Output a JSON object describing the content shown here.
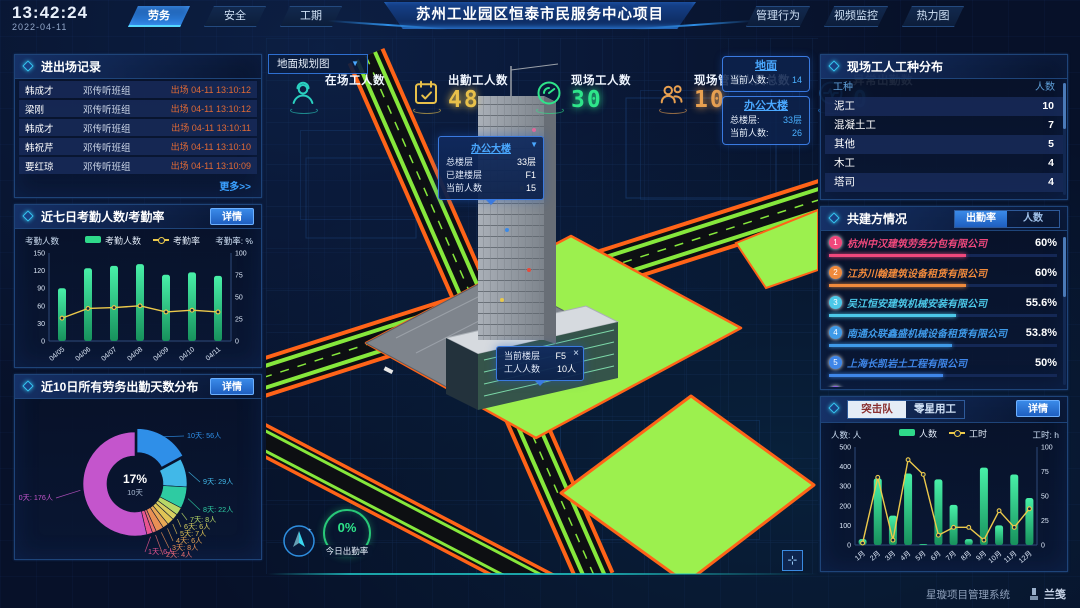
{
  "topbar": {
    "time": "13:42:24",
    "date": "2022-04-11",
    "left_tabs": [
      {
        "label": "劳务",
        "active": true
      },
      {
        "label": "安全",
        "active": false
      },
      {
        "label": "工期",
        "active": false
      }
    ],
    "title": "苏州工业园区恒泰市民服务中心项目",
    "right_tabs": [
      {
        "label": "管理行为",
        "active": false
      },
      {
        "label": "视频监控",
        "active": false
      },
      {
        "label": "热力图",
        "active": false
      }
    ]
  },
  "entry_exit": {
    "title": "进出场记录",
    "more_label": "更多>>",
    "rows": [
      {
        "name": "韩成才",
        "group": "邓传听班组",
        "event": "出场 04-11 13:10:12"
      },
      {
        "name": "梁刚",
        "group": "邓传听班组",
        "event": "出场 04-11 13:10:12"
      },
      {
        "name": "韩成才",
        "group": "邓传听班组",
        "event": "出场 04-11 13:10:11"
      },
      {
        "name": "韩祝芹",
        "group": "邓传听班组",
        "event": "出场 04-11 13:10:10"
      },
      {
        "name": "要红琼",
        "group": "邓传听班组",
        "event": "出场 04-11 13:10:09"
      }
    ]
  },
  "attendance_panel": {
    "title": "近七日考勤人数/考勤率",
    "detail_label": "详情"
  },
  "distribution_panel": {
    "title": "近10日所有劳务出勤天数分布",
    "detail_label": "详情"
  },
  "map": {
    "dropdown": "地面规划图",
    "stats": [
      {
        "label": "在场工人数",
        "value": "",
        "color": "#2ad0c0",
        "icon": "worker-icon"
      },
      {
        "label": "出勤工人数",
        "value": "48",
        "color": "#e8c04a",
        "icon": "calendar-check-icon"
      },
      {
        "label": "现场工人数",
        "value": "30",
        "color": "#2ee58a",
        "icon": "gauge-icon"
      },
      {
        "label": "现场管理人员总数",
        "value": "10",
        "color": "#e8a050",
        "icon": "people-icon"
      },
      {
        "label": "异常出勤数",
        "value": "0",
        "color": "#2e9fff",
        "icon": "pulse-icon"
      }
    ],
    "building_tooltip": {
      "title": "办公大楼",
      "rows": [
        [
          "总楼层",
          "33层"
        ],
        [
          "已建楼层",
          "F1"
        ],
        [
          "当前人数",
          "15"
        ]
      ]
    },
    "floor_tooltip": {
      "rows": [
        [
          "当前楼层",
          "F5"
        ],
        [
          "工人人数",
          "10人"
        ]
      ],
      "close": "×"
    },
    "info_cards": [
      {
        "title": "地面",
        "rows": [
          [
            "当前人数:",
            "14"
          ]
        ]
      },
      {
        "title": "办公大楼",
        "rows": [
          [
            "总楼层:",
            "33层"
          ],
          [
            "当前人数:",
            "26"
          ]
        ]
      }
    ],
    "gauge": {
      "value": "0%",
      "label": "今日出勤率"
    }
  },
  "worker_types": {
    "title": "现场工人工种分布",
    "columns": [
      "工种",
      "人数"
    ],
    "rows": [
      [
        "泥工",
        "10"
      ],
      [
        "混凝土工",
        "7"
      ],
      [
        "其他",
        "5"
      ],
      [
        "木工",
        "4"
      ],
      [
        "塔司",
        "4"
      ]
    ]
  },
  "partners": {
    "title": "共建方情况",
    "tabs": [
      "出勤率",
      "人数"
    ],
    "rows": [
      {
        "rank": "1",
        "name": "杭州中汉建筑劳务分包有限公司",
        "value": "60%",
        "pct": 60,
        "color": "#f0487c"
      },
      {
        "rank": "2",
        "name": "江苏川翰建筑设备租赁有限公司",
        "value": "60%",
        "pct": 60,
        "color": "#f08a3c"
      },
      {
        "rank": "3",
        "name": "吴江恒安建筑机械安装有限公司",
        "value": "55.6%",
        "pct": 55.6,
        "color": "#4cc8e8"
      },
      {
        "rank": "4",
        "name": "南通众联鑫盛机械设备租赁有限公司",
        "value": "53.8%",
        "pct": 53.8,
        "color": "#3f9ae8"
      },
      {
        "rank": "5",
        "name": "上海长凯岩土工程有限公司",
        "value": "50%",
        "pct": 50,
        "color": "#3f86e8"
      },
      {
        "rank": "6",
        "name": "江苏法诺建筑安装工程有限公司",
        "value": "35.4%",
        "pct": 35.4,
        "color": "#8f5ae8"
      }
    ]
  },
  "squad_panel": {
    "tabs": [
      "突击队",
      "零星用工"
    ],
    "detail_label": "详情"
  },
  "footer": {
    "system_name": "星璇项目管理系统",
    "logo_text": "兰笺"
  },
  "chart_data": [
    {
      "id": "attendance",
      "type": "bar",
      "title": "近七日考勤人数/考勤率",
      "categories": [
        "04/05",
        "04/06",
        "04/07",
        "04/08",
        "04/09",
        "04/10",
        "04/11"
      ],
      "series": [
        {
          "name": "考勤人数",
          "type": "bar",
          "values": [
            90,
            124,
            128,
            131,
            113,
            117,
            111
          ],
          "color": "#2fd98a"
        },
        {
          "name": "考勤率",
          "type": "line",
          "values": [
            26,
            37,
            38,
            40,
            33,
            35,
            33
          ],
          "color": "#ecc94b",
          "axis": "right"
        }
      ],
      "y_left": {
        "label": "考勤人数",
        "min": 0,
        "max": 150,
        "step": 30
      },
      "y_right": {
        "label": "考勤率: %",
        "min": 0,
        "max": 100,
        "step": 25
      },
      "legend_position": "top",
      "grid": false
    },
    {
      "id": "attendance-days",
      "type": "pie",
      "title": "近10日所有劳务出勤天数分布",
      "labels": [
        "10天",
        "9天",
        "8天",
        "7天",
        "6天",
        "5天",
        "4天",
        "3天",
        "2天",
        "1天",
        "0天"
      ],
      "values": [
        56,
        29,
        22,
        8,
        6,
        7,
        6,
        8,
        4,
        6,
        176
      ],
      "unit": "人",
      "colors": [
        "#2f8fe8",
        "#41b8e8",
        "#2ecba2",
        "#b8d867",
        "#d8cf60",
        "#e0c455",
        "#e8a855",
        "#e89055",
        "#e87070",
        "#e85590",
        "#c455cc"
      ],
      "center": {
        "percent": "17%",
        "label": "10天"
      },
      "donut": true
    },
    {
      "id": "squad",
      "type": "bar",
      "title": "突击队",
      "categories": [
        "1月",
        "2月",
        "3月",
        "4月",
        "5月",
        "6月",
        "7月",
        "8月",
        "9月",
        "10月",
        "11月",
        "12月"
      ],
      "series": [
        {
          "name": "人数",
          "type": "bar",
          "values": [
            30,
            340,
            150,
            365,
            5,
            335,
            205,
            30,
            395,
            100,
            360,
            240
          ],
          "color": "#2fd98a"
        },
        {
          "name": "工时",
          "type": "line",
          "values": [
            2,
            69,
            5,
            87,
            72,
            10,
            18,
            18,
            5,
            35,
            18,
            37
          ],
          "color": "#ecc94b",
          "axis": "right"
        }
      ],
      "y_left": {
        "label": "人数: 人",
        "min": 0,
        "max": 500,
        "step": 100
      },
      "y_right": {
        "label": "工时: h",
        "min": 0,
        "max": 100,
        "step": 25
      },
      "legend_position": "top",
      "grid": false
    }
  ]
}
